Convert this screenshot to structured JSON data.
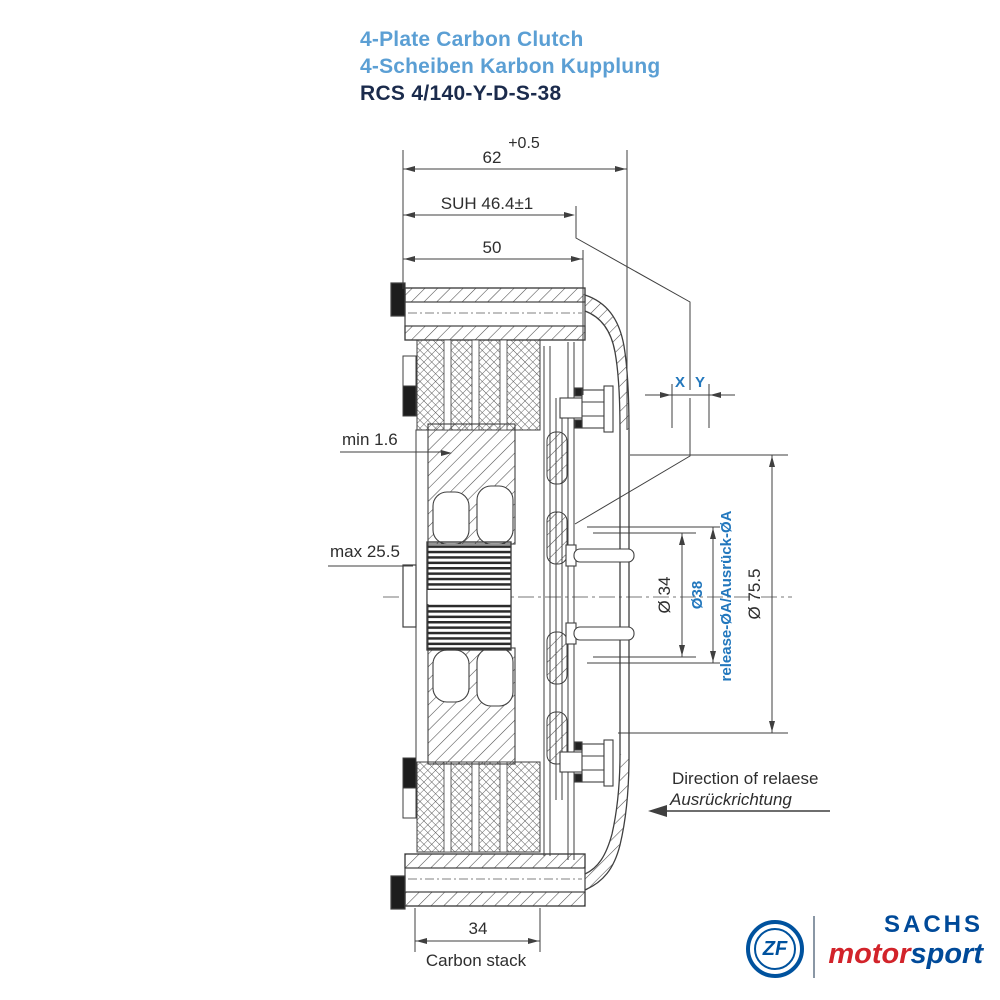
{
  "header": {
    "title_en": "4-Plate Carbon Clutch",
    "title_de": "4-Scheiben Karbon Kupplung",
    "model": "RCS 4/140-Y-D-S-38"
  },
  "dimensions": {
    "width_tolerance": "+0.5",
    "overall_width": "62",
    "suh": "SUH 46.4±1",
    "width_50": "50",
    "min_wear": "min 1.6",
    "max_travel": "max 25.5",
    "x_label": "X",
    "y_label": "Y",
    "dia_34": "Ø 34",
    "dia_38": "Ø38",
    "release_label": "release-ØA/Ausrück-ØA",
    "dia_75_5": "Ø 75.5",
    "carbon_stack_value": "34",
    "carbon_stack_label": "Carbon stack",
    "direction_en": "Direction of relaese",
    "direction_de": "Ausrückrichtung"
  },
  "branding": {
    "zf": "ZF",
    "sachs": "SACHS",
    "motor": "motor",
    "sport": "sport"
  },
  "colors": {
    "title_blue": "#5b9fd4",
    "model_navy": "#1b2b4c",
    "annotation_blue": "#2277bd",
    "drawing_line": "#3f3f3f",
    "zf_blue": "#00529e",
    "sachs_blue": "#004a99",
    "motor_red": "#d2232a"
  }
}
